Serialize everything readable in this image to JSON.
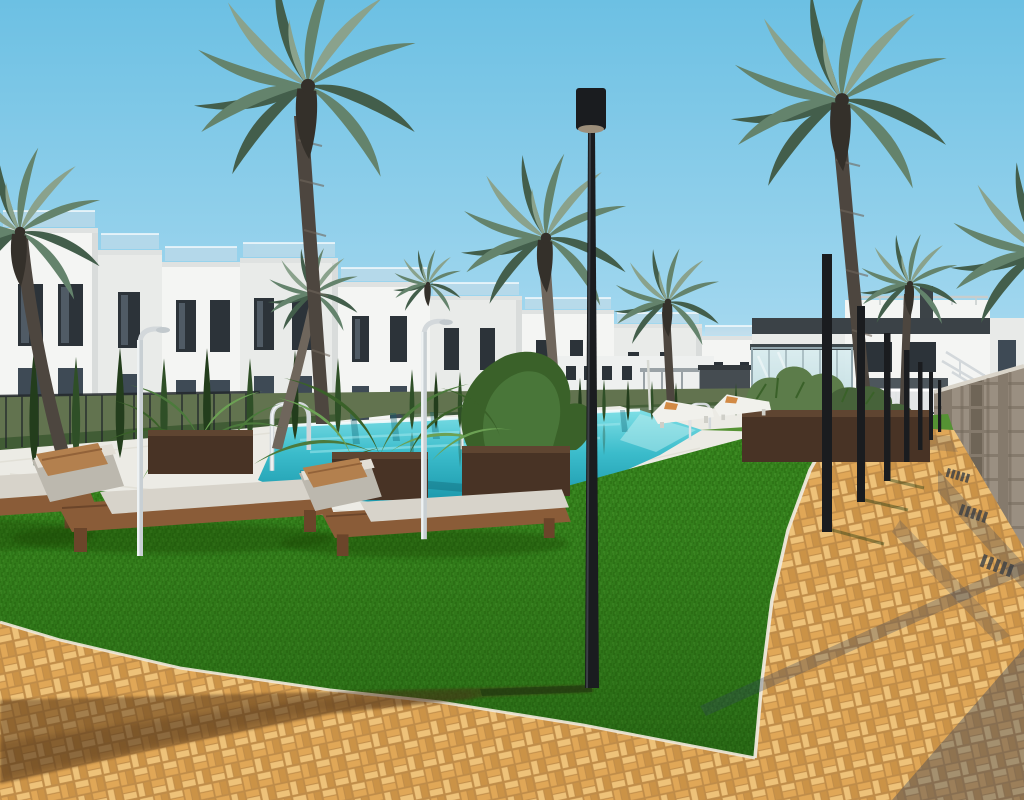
{
  "scene": {
    "type": "architectural-render-photo",
    "caption": "New-build residential complex: white townhouses and apartments around a turquoise communal pool, palm trees, sun loungers on artificial lawn, tall black lamp posts and an orange brick-paved walkway under a clear blue sky.",
    "objects": [
      "sky",
      "row-of-white-townhouses",
      "modern-apartment-building-right",
      "glass-pavilion",
      "stone-retaining-wall",
      "staircase-railing",
      "swimming-pool",
      "pool-handrails",
      "pool-deck",
      "wooden-planter-boxes",
      "banana-plants",
      "cypress-trees",
      "palm-trees",
      "artificial-lawn",
      "tall-lamp-post",
      "bollard-lamp-row",
      "outdoor-showers",
      "wooden-sun-loungers-with-cushions",
      "distant-white-loungers",
      "brick-paved-walkway",
      "metal-fence",
      "palm-shadow"
    ],
    "lighting": "bright midday sun, shadows falling across paving",
    "counts": {
      "foreground_loungers": 3,
      "distant_loungers": 2,
      "bollard_lamps": 7,
      "pool_handrails": 3
    }
  },
  "palette": {
    "sky-top": "#6cc0e3",
    "sky-mid": "#9fd6ee",
    "sky-low": "#d8edf7",
    "bldg-white": "#f4f5f3",
    "bldg-shade": "#e9ebe9",
    "bldg-dark": "#d9dcdb",
    "parapet": "#dfe2e1",
    "win": "#2c3339",
    "win-glass": "#3e4a55",
    "rail-glass": "#c8dde9",
    "roofband": "#3b4247",
    "cube-fill": "#c4e2e6",
    "cube-aqua": "#54c5cd",
    "cube-frame": "#93a7ae",
    "deck": "#ecebe5",
    "deck-shade": "#d8d5ca",
    "garden": "#62734f",
    "hedge": "#3e5a32",
    "cypress": "#2f4f27",
    "cypress-dark": "#233d1c",
    "pool-light": "#7fdfe6",
    "pool-mid": "#3bbccb",
    "pool-deep": "#1995a9",
    "pool-dark": "#0d5f6e",
    "grass": "#35821d",
    "grass-dark": "#27680f",
    "grass-light": "#4c9c31",
    "grass-distant": "#559233",
    "palm-light": "#8aa28c",
    "palm-mid": "#64836c",
    "palm-dark": "#435e4b",
    "palm-tuft": "#34302a",
    "trunk": "#4d463f",
    "trunk-light": "#6f665c",
    "brick-light": "#eec279",
    "brick-mid": "#e0a757",
    "brick-joint": "#bf8c49",
    "brick-shade": "#cb9347",
    "curb": "#efe9dc",
    "stone-1": "#9a8f81",
    "stone-2": "#857a6c",
    "stone-3": "#6f6557",
    "stone-cap": "#d9d4c9",
    "pole": "#1a1c1f",
    "pole-lens": "#9c8e7a",
    "chrome": "#d3d8db",
    "wood": "#8a5c38",
    "wood-dark": "#6b452a",
    "cushion": "#d7d3ca",
    "cushion-shade": "#bcb8ae",
    "pillow": "#b3804e",
    "pillow-dark": "#926239",
    "pillow-orange": "#d28a45",
    "lounger-white": "#f1f1ec",
    "planter": "#483325",
    "planter-light": "#5f4531",
    "banana": "#4c7a3c",
    "banana-light": "#6ca154",
    "banana-dark": "#3a6129",
    "shrub": "#5c7c4a",
    "shadow-cool": "#2e3f5e",
    "fence": "#23282c",
    "distant-dark": "#454c51",
    "distant-bldg": "#eef0ef"
  }
}
